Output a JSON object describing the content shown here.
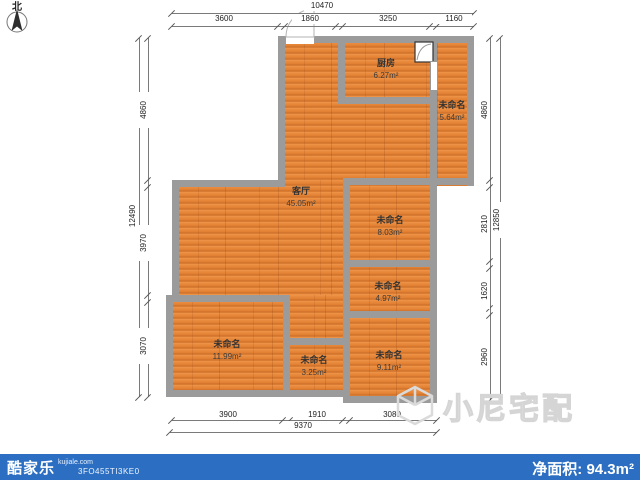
{
  "compass": {
    "label": "北"
  },
  "plan": {
    "rooms": [
      {
        "name": "厨房",
        "area": "6.27m²"
      },
      {
        "name": "未命名",
        "area": "5.64m²"
      },
      {
        "name": "客厅",
        "area": "45.05m²"
      },
      {
        "name": "未命名",
        "area": "8.03m²"
      },
      {
        "name": "未命名",
        "area": "4.97m²"
      },
      {
        "name": "未命名",
        "area": "11.99m²"
      },
      {
        "name": "未命名",
        "area": "3.25m²"
      },
      {
        "name": "未命名",
        "area": "9.11m²"
      }
    ]
  },
  "dimensions": {
    "top": {
      "overall": "10470",
      "segments": [
        "3600",
        "1860",
        "3250",
        "1160"
      ]
    },
    "left": {
      "overall": "12490",
      "segments": [
        "4860",
        "3970",
        "3070"
      ]
    },
    "right": {
      "overall": "12850",
      "segments": [
        "4860",
        "2810",
        "1620",
        "2960"
      ]
    },
    "bottom": {
      "overall": "9370",
      "segments": [
        "3900",
        "1910",
        "3080"
      ]
    }
  },
  "watermark": {
    "text": "小尼宅配"
  },
  "footer": {
    "brand": "酷家乐",
    "domain": "kujiale.com",
    "code": "3FO455TI3KE0",
    "net_area": "净面积: 94.3m²"
  },
  "icons": {
    "compass": "north-compass-arrow",
    "entry_door": "door-swing-arc",
    "kitchen_fixture": "door-swing-small",
    "window": "wall-window",
    "watermark_logo": "cube-outline"
  },
  "colors": {
    "floor": "#e2812f",
    "wall": "#9b9b9b",
    "footer_bar": "#2c6fc2",
    "dimension_line": "#7a7a7a",
    "watermark": "#d5d5d5"
  }
}
